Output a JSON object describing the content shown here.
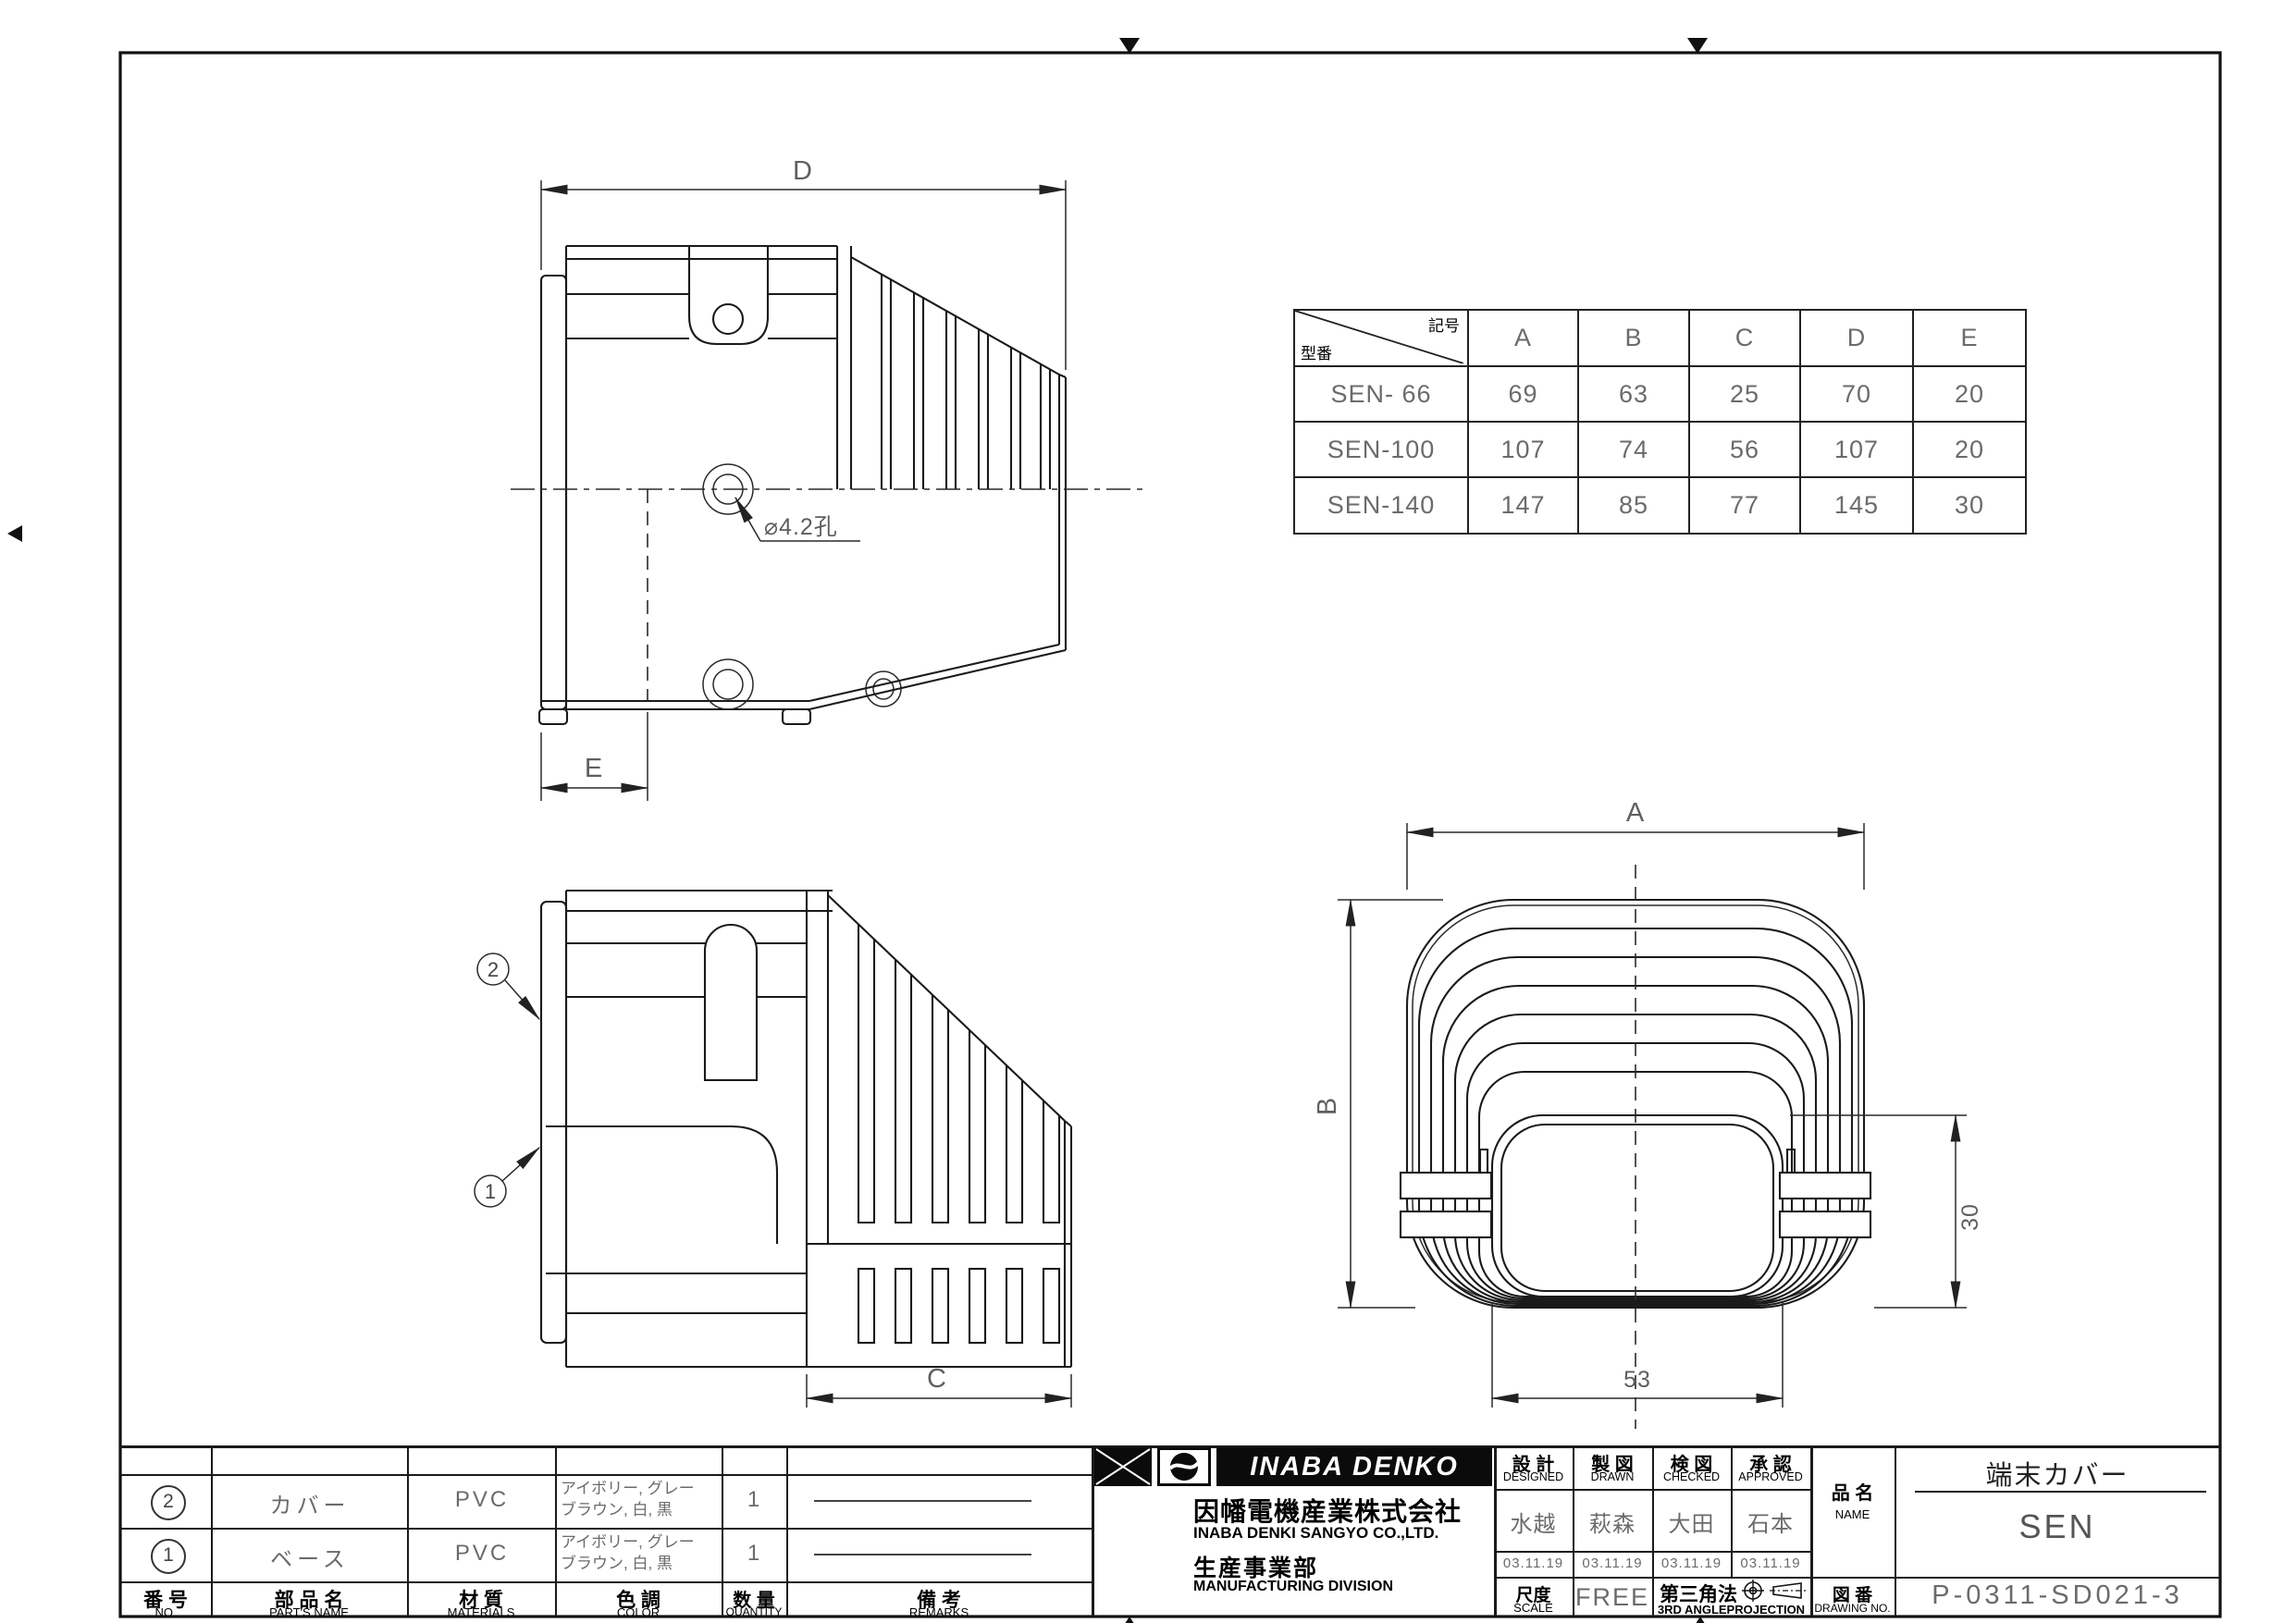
{
  "colors": {
    "line": "#1a1a1a",
    "cad_text": "#6b6b6b",
    "ink": "#000000"
  },
  "views": {
    "side_top": {
      "dim_d": "D",
      "dim_e": "E",
      "hole_label": "⌀4.2孔"
    },
    "side_bottom": {
      "dim_c": "C",
      "balloon_1": "1",
      "balloon_2": "2"
    },
    "front": {
      "dim_a": "A",
      "dim_b": "B",
      "dim_30": "30",
      "dim_53": "53"
    }
  },
  "size_table": {
    "corner": {
      "top_right": "記号",
      "bottom_left": "型番"
    },
    "columns": [
      "A",
      "B",
      "C",
      "D",
      "E"
    ],
    "rows": [
      {
        "model": "SEN- 66",
        "values": [
          "69",
          "63",
          "25",
          "70",
          "20"
        ]
      },
      {
        "model": "SEN-100",
        "values": [
          "107",
          "74",
          "56",
          "107",
          "20"
        ]
      },
      {
        "model": "SEN-140",
        "values": [
          "147",
          "85",
          "77",
          "145",
          "30"
        ]
      }
    ]
  },
  "parts_table": {
    "headers": [
      {
        "jp": "番 号",
        "en": "NO."
      },
      {
        "jp": "部 品 名",
        "en": "PART'S NAME"
      },
      {
        "jp": "材 質",
        "en": "MATERIALS"
      },
      {
        "jp": "色 調",
        "en": "COLOR"
      },
      {
        "jp": "数 量",
        "en": "QUANTITY"
      },
      {
        "jp": "備  考",
        "en": "REMARKS"
      }
    ],
    "rows": [
      {
        "no": "2",
        "name": "カバー",
        "material": "PVC",
        "color_line1": "アイボリー, グレー",
        "color_line2": "ブラウン, 白, 黒",
        "qty": "1"
      },
      {
        "no": "1",
        "name": "ベース",
        "material": "PVC",
        "color_line1": "アイボリー, グレー",
        "color_line2": "ブラウン, 白, 黒",
        "qty": "1"
      }
    ]
  },
  "company": {
    "logo_text": "INABA DENKO",
    "name_jp": "因幡電機産業株式会社",
    "name_en": "INABA DENKI SANGYO CO.,LTD.",
    "division_jp": "生産事業部",
    "division_en": "MANUFACTURING DIVISION"
  },
  "approvals": [
    {
      "jp": "設 計",
      "en": "DESIGNED",
      "name": "水越",
      "date": "03.11.19"
    },
    {
      "jp": "製 図",
      "en": "DRAWN",
      "name": "萩森",
      "date": "03.11.19"
    },
    {
      "jp": "検 図",
      "en": "CHECKED",
      "name": "大田",
      "date": "03.11.19"
    },
    {
      "jp": "承 認",
      "en": "APPROVED",
      "name": "石本",
      "date": "03.11.19"
    }
  ],
  "title_block": {
    "scale_label_jp": "尺度",
    "scale_label_en": "SCALE",
    "scale_value": "FREE",
    "projection_jp": "第三角法",
    "projection_en": "3RD ANGLEPROJECTION",
    "name_label_jp": "品 名",
    "name_label_en": "NAME",
    "product_title": "端末カバー",
    "product_name": "SEN",
    "drawing_no_label_jp": "図 番",
    "drawing_no_label_en": "DRAWING NO.",
    "drawing_no": "P-0311-SD021-3"
  }
}
